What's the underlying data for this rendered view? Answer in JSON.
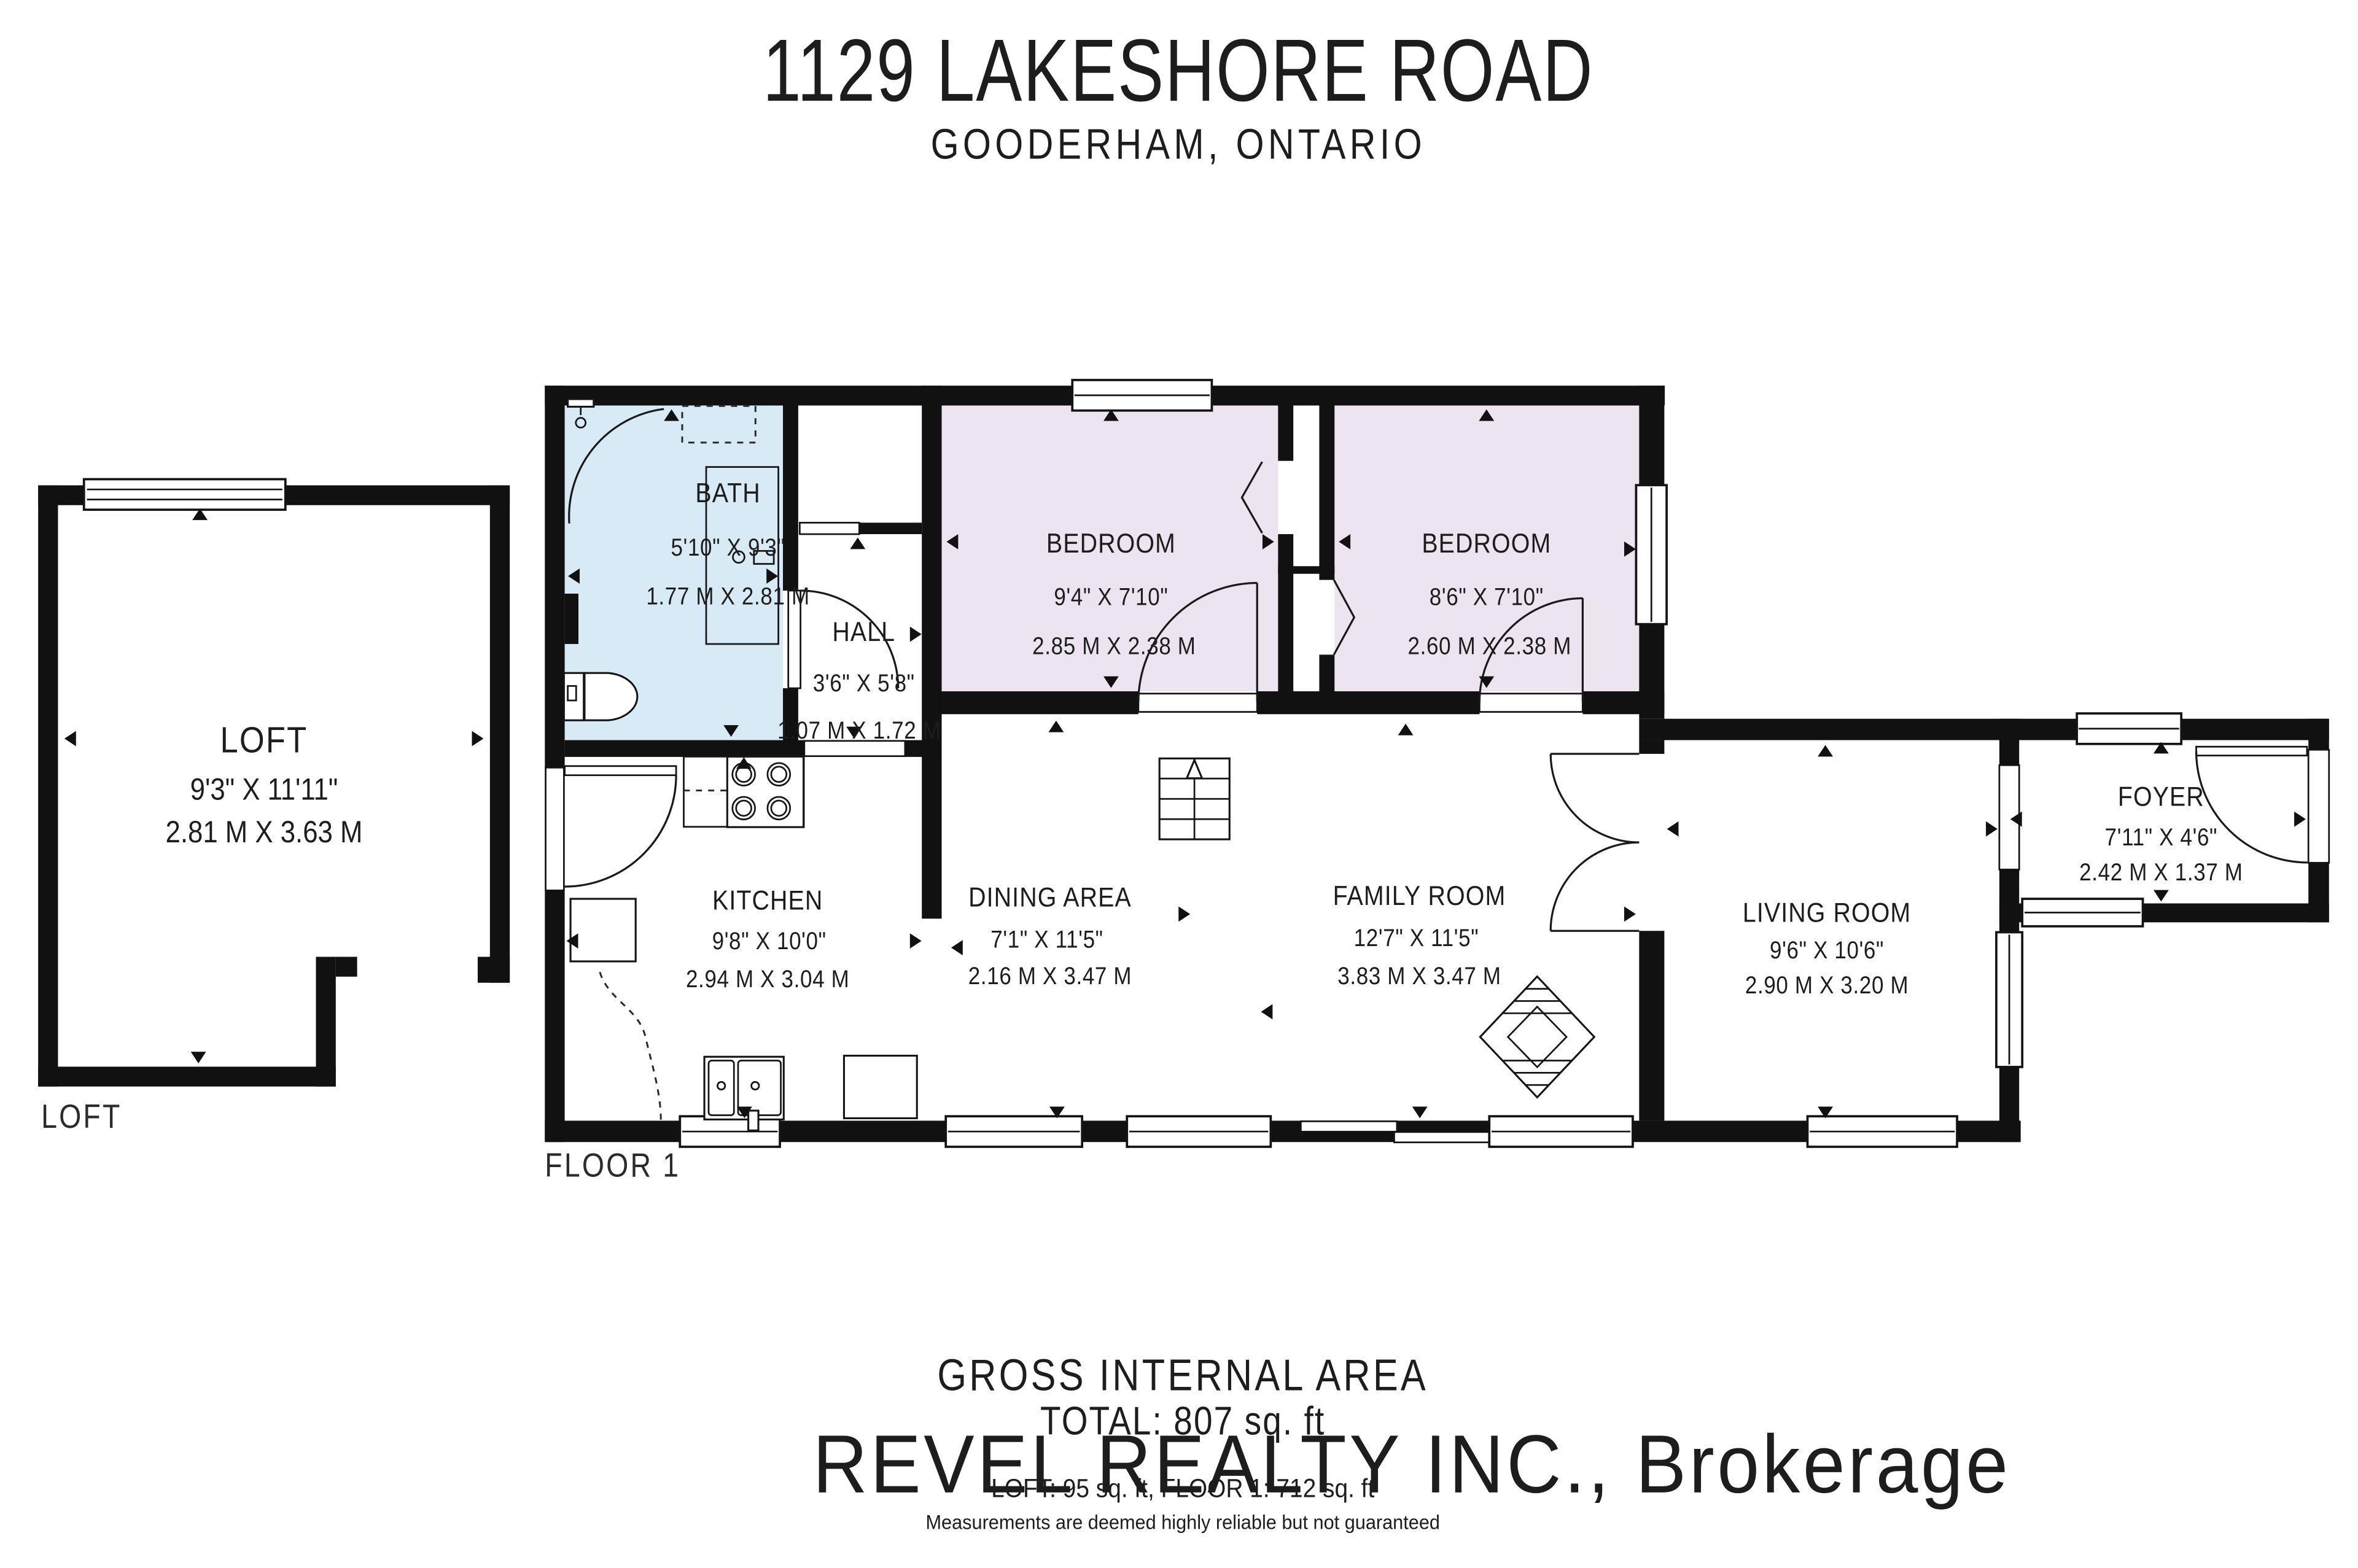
{
  "header": {
    "title": "1129 LAKESHORE ROAD",
    "subtitle": "GOODERHAM, ONTARIO"
  },
  "watermark": {
    "text": "REVEL REALTY INC., Brokerage"
  },
  "loft_plan": {
    "floor_label": "LOFT",
    "rooms": {
      "loft": {
        "name": "LOFT",
        "imperial": "9'3\" X 11'11\"",
        "metric": "2.81 M X 3.63 M"
      }
    }
  },
  "floor1_plan": {
    "floor_label": "FLOOR 1",
    "rooms": {
      "bath": {
        "name": "BATH",
        "imperial": "5'10\" X 9'3\"",
        "metric": "1.77 M X 2.81 M"
      },
      "hall": {
        "name": "HALL",
        "imperial": "3'6\" X 5'8\"",
        "metric": "1.07 M X 1.72 M"
      },
      "bedroom1": {
        "name": "BEDROOM",
        "imperial": "9'4\" X 7'10\"",
        "metric": "2.85 M X 2.38 M"
      },
      "bedroom2": {
        "name": "BEDROOM",
        "imperial": "8'6\" X 7'10\"",
        "metric": "2.60 M X 2.38 M"
      },
      "kitchen": {
        "name": "KITCHEN",
        "imperial": "9'8\" X 10'0\"",
        "metric": "2.94 M X 3.04 M"
      },
      "dining": {
        "name": "DINING AREA",
        "imperial": "7'1\" X 11'5\"",
        "metric": "2.16 M X 3.47 M"
      },
      "family": {
        "name": "FAMILY ROOM",
        "imperial": "12'7\" X 11'5\"",
        "metric": "3.83 M X 3.47 M"
      },
      "living": {
        "name": "LIVING ROOM",
        "imperial": "9'6\" X 10'6\"",
        "metric": "2.90 M X 3.20 M"
      },
      "foyer": {
        "name": "FOYER",
        "imperial": "7'11\" X 4'6\"",
        "metric": "2.42 M X 1.37 M"
      }
    }
  },
  "footer": {
    "gross_label": "GROSS INTERNAL AREA",
    "total": "TOTAL: 807 sq. ft",
    "breakdown": "LOFT: 95 sq. ft, FLOOR 1: 712 sq. ft",
    "disclaimer": "Measurements are deemed highly reliable but not guaranteed"
  },
  "colors": {
    "wall": "#111111",
    "bath_fill": "#d9eaf7",
    "bedroom_fill": "#ece4ee",
    "watermark": "#cbcbcb",
    "disclaimer": "#8f8f8f"
  }
}
